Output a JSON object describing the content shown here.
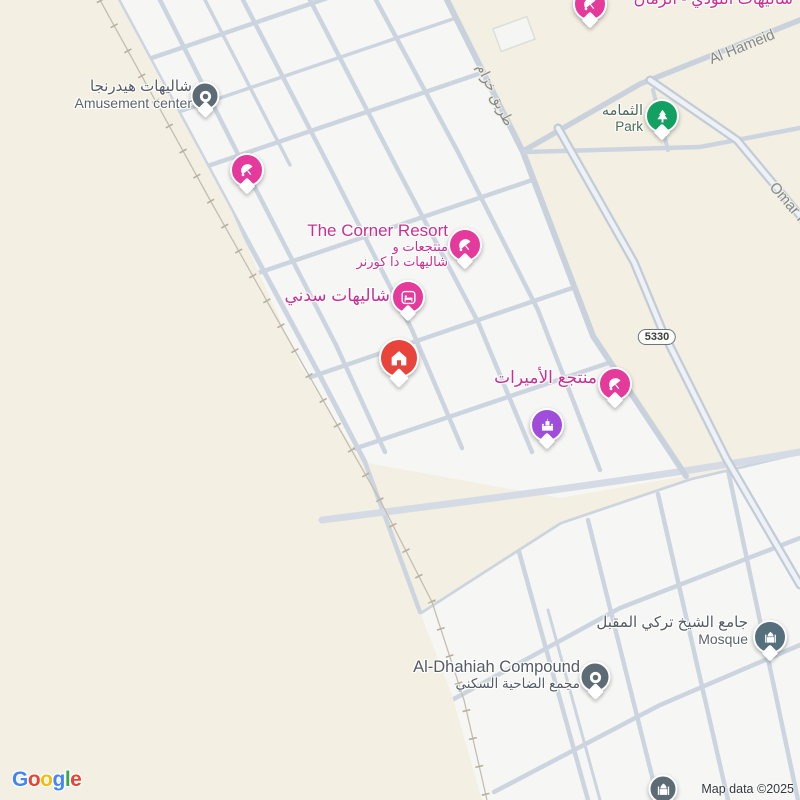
{
  "colors": {
    "desert_bg": "#f3efe2",
    "city_block": "#f6f7f4",
    "road": "#ccd5df",
    "major_road_casing": "#c2ccd7",
    "major_road_fill": "#eef1f5",
    "railway": "#b7b0a1",
    "poi_pink": "#e5399c",
    "poi_red": "#e8443c",
    "poi_purple": "#a04ddb",
    "poi_green": "#13a161",
    "poi_slate": "#5d6b74",
    "poi_mosque": "#566f7d",
    "label_pink": "#c92f92",
    "label_gray": "#545b63",
    "label_green": "#4a6b57",
    "road_label": "#83898f"
  },
  "pois": [
    {
      "id": "hydrangea-chalets",
      "title_ar": "شاليهات هيدرنجا",
      "title_en": "Amusement center",
      "icon": "dot",
      "color": "#5d6b74",
      "x": 205,
      "y": 96
    },
    {
      "id": "nudi-chalets",
      "title": "شاليهات النودي - الرمان",
      "icon": "beach-umbrella",
      "color": "#e5399c",
      "x": 590,
      "y": 4
    },
    {
      "id": "thumamah-park",
      "title_ar": "الثمامه",
      "title_en": "Park",
      "icon": "tree",
      "color": "#13a161",
      "x": 662,
      "y": 116
    },
    {
      "id": "beach-resort",
      "icon": "beach-umbrella",
      "color": "#e5399c",
      "x": 247,
      "y": 170
    },
    {
      "id": "corner-resort",
      "title": "The Corner Resort",
      "subtitle_ar_1": "منتجعات و",
      "subtitle_ar_2": "شاليهات دا كورنر",
      "icon": "beach-umbrella",
      "color": "#e5399c",
      "x": 465,
      "y": 245
    },
    {
      "id": "sydney-chalets",
      "title": "شاليهات سدني",
      "icon": "bed",
      "color": "#e5399c",
      "x": 408,
      "y": 297
    },
    {
      "id": "selected-property",
      "icon": "house",
      "color": "#e8443c",
      "x": 399,
      "y": 358
    },
    {
      "id": "princesses-resort",
      "title": "منتجع الأميرات",
      "icon": "beach-umbrella",
      "color": "#e5399c",
      "x": 615,
      "y": 384
    },
    {
      "id": "attraction",
      "icon": "palace",
      "color": "#a04ddb",
      "x": 547,
      "y": 425
    },
    {
      "id": "sheikh-turki-mosque",
      "title_ar": "جامع الشيخ تركي المقبل",
      "title_en": "Mosque",
      "icon": "mosque",
      "color": "#566f7d",
      "x": 770,
      "y": 637
    },
    {
      "id": "dhahiah-compound",
      "title_en": "Al-Dhahiah Compound",
      "title_ar": "مجمع الضاحية السكني",
      "icon": "dot",
      "color": "#5d6b74",
      "x": 595,
      "y": 677
    },
    {
      "id": "edge-mosque",
      "icon": "mosque",
      "color": "#5d6b74",
      "x": 663,
      "y": 789
    }
  ],
  "road_labels": [
    {
      "text": "طريق خزام"
    },
    {
      "text": "Al Hameid"
    },
    {
      "text": "Omar Ib"
    }
  ],
  "route_badge": {
    "number": "5330"
  },
  "attribution": {
    "copyright": "Map data ©2025",
    "logo_letters": [
      {
        "ch": "G"
      },
      {
        "ch": "o"
      },
      {
        "ch": "o"
      },
      {
        "ch": "g"
      },
      {
        "ch": "l"
      },
      {
        "ch": "e"
      }
    ]
  }
}
